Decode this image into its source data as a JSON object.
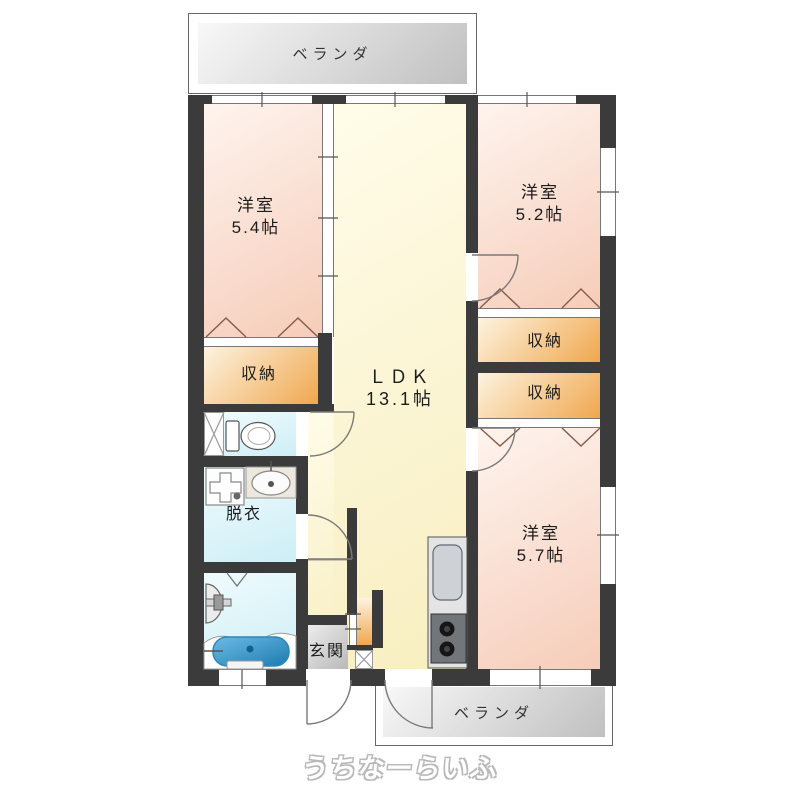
{
  "palette": {
    "wall": "#3b3b3b",
    "line": "#777777",
    "room_pink_light": "#fef4ee",
    "room_pink": "#f6ccb9",
    "ldk_light": "#fffce9",
    "ldk_yellow": "#f8eec0",
    "closet_light": "#fdf3e0",
    "closet_orange": "#f0a74e",
    "water_light": "#effbfd",
    "water_cyan": "#cdeef6",
    "veranda_light": "#f8f8f8",
    "veranda_gray": "#c0c0c0",
    "genkan_light": "#ececec",
    "genkan_gray": "#b7b7b7",
    "tub_blue_light": "#6cbbe4",
    "tub_blue": "#1d7cb0"
  },
  "labels": {
    "balcony_top": "ベランダ",
    "balcony_bottom": "ベランダ",
    "room_nw_name": "洋室",
    "room_nw_size": "5.4帖",
    "room_ne_name": "洋室",
    "room_ne_size": "5.2帖",
    "room_se_name": "洋室",
    "room_se_size": "5.7帖",
    "ldk_name": "ＬＤＫ",
    "ldk_size": "13.1帖",
    "closet_nw": "収納",
    "closet_ne": "収納",
    "closet_e": "収納",
    "dressing_room": "脱衣",
    "entrance": "玄関",
    "watermark": "うちなーらいふ"
  }
}
